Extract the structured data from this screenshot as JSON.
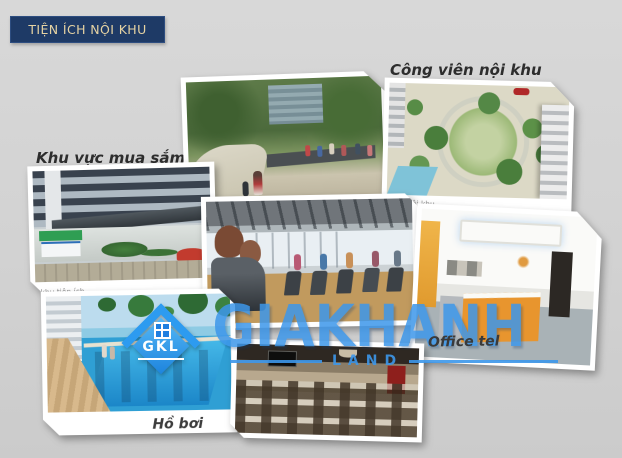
{
  "banner": {
    "title": "TIỆN ÍCH NỘI KHU"
  },
  "labels": {
    "aerial_park": "Công viên nội khu",
    "shopping": "Khu vực mua sắm",
    "pool": "Hồ bơi",
    "office": "Office tel"
  },
  "captions": {
    "aerial_photo": "sân nội khu",
    "shopping_photo": "khu tiện ích"
  },
  "watermark": {
    "brand": "GIAKHANH",
    "division": "LAND",
    "logo_initials": "GKL"
  },
  "photos": [
    {
      "id": "shopping",
      "desc": "shopping-area-building-entrance-photo"
    },
    {
      "id": "park",
      "desc": "landscaped-walking-park-photo"
    },
    {
      "id": "aerial",
      "desc": "aerial-inner-courtyard-park-photo"
    },
    {
      "id": "gym",
      "desc": "fitness-gym-treadmills-photo"
    },
    {
      "id": "office",
      "desc": "office-reception-lobby-photo"
    },
    {
      "id": "pool",
      "desc": "swimming-pool-photo"
    },
    {
      "id": "restaurant",
      "desc": "restaurant-dining-room-photo"
    }
  ],
  "colors": {
    "banner_bg": "#1e3a66",
    "banner_text": "#e6d3a3",
    "watermark_blue": "#3d97ea",
    "background": "#d2d2d2"
  }
}
